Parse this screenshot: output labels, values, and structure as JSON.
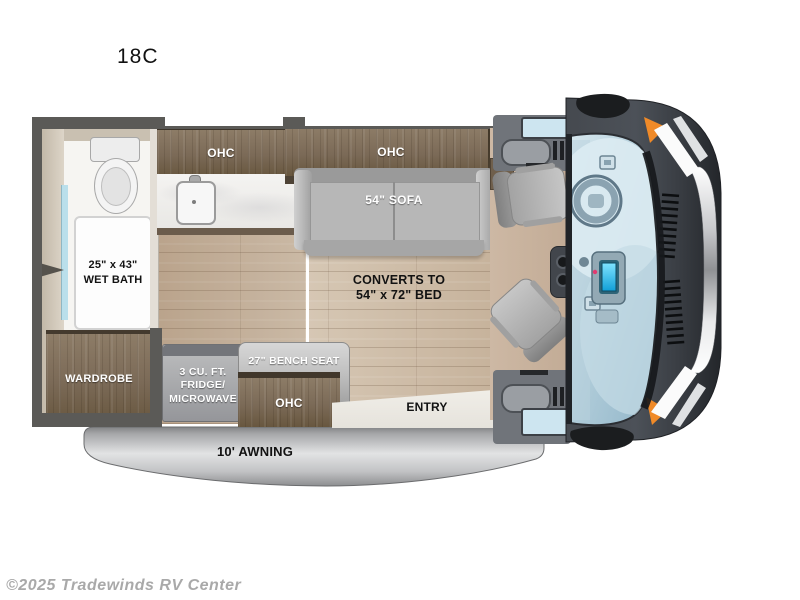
{
  "page": {
    "title": "18C",
    "watermark": "©2025 Tradewinds RV Center"
  },
  "floorplan": {
    "labels": {
      "ohc": "OHC",
      "sofa": "54\" SOFA",
      "wet_bath": {
        "line1": "25\" x 43\"",
        "line2": "WET BATH"
      },
      "bed": {
        "line1": "CONVERTS TO",
        "line2": "54\" x 72\" BED"
      },
      "wardrobe": "WARDROBE",
      "fridge": {
        "line1": "3 CU. FT.",
        "line2": "FRIDGE/",
        "line3": "MICROWAVE"
      },
      "bench_seat": "27\" BENCH SEAT",
      "entry": "ENTRY",
      "awning": "10' AWNING"
    },
    "colors": {
      "wall": "#5b5a57",
      "cabinet_wood": "#7b6a57",
      "floor_wood": "#c8b6a1",
      "sofa_gray": "#b7b7b7",
      "counter_marble": "#f1f0ee",
      "awning_gray": "#c2c3c5",
      "van_body": "#45494f",
      "windshield_glass": "#b5d0dd",
      "accent_orange": "#f08a28",
      "bed_outline": "#ffffff"
    }
  }
}
